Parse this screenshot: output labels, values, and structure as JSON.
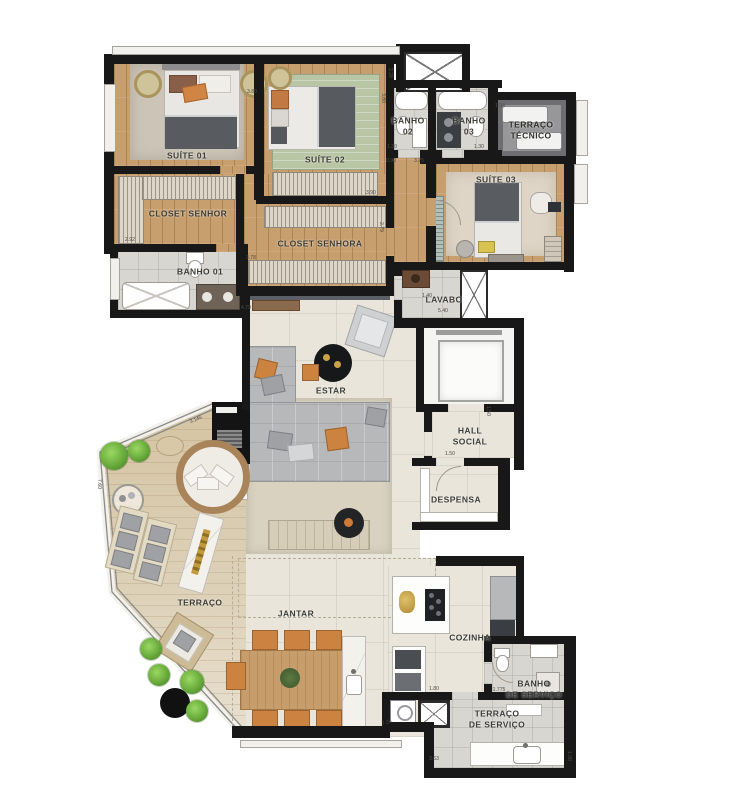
{
  "plan": {
    "title": "apartment floor plan",
    "rooms": {
      "suite01": {
        "label": "SUÍTE 01"
      },
      "suite02": {
        "label": "SUÍTE 02"
      },
      "suite03": {
        "label": "SUÍTE 03"
      },
      "closet_senhor": {
        "label": "CLOSET SENHOR"
      },
      "closet_senhora": {
        "label": "CLOSET SENHORA"
      },
      "banho01": {
        "label": "BANHO 01"
      },
      "banho02": {
        "label": "BANHO\n02"
      },
      "banho03": {
        "label": "BANHO\n03"
      },
      "terraco_tecnico": {
        "label": "TERRAÇO\nTÉCNICO"
      },
      "lavabo": {
        "label": "LAVABO"
      },
      "hall_social": {
        "label": "HALL\nSOCIAL"
      },
      "despensa": {
        "label": "DESPENSA"
      },
      "estar": {
        "label": "ESTAR"
      },
      "terraco": {
        "label": "TERRAÇO"
      },
      "jantar": {
        "label": "JANTAR"
      },
      "cozinha": {
        "label": "COZINHA"
      },
      "banho_servico": {
        "label": "BANHO\nDE SERVIÇO"
      },
      "terraco_servico": {
        "label": "TERRAÇO\nDE SERVIÇO"
      }
    },
    "dimensions": [
      {
        "text": "3.80",
        "x": 252,
        "y": 92,
        "r": 0
      },
      {
        "text": "2.28",
        "x": 390,
        "y": 73,
        "r": 90
      },
      {
        "text": "3.80",
        "x": 383,
        "y": 98,
        "r": 90
      },
      {
        "text": "1.30",
        "x": 392,
        "y": 147,
        "r": 0
      },
      {
        "text": "1.30",
        "x": 479,
        "y": 147,
        "r": 0
      },
      {
        "text": "0.90",
        "x": 391,
        "y": 161,
        "r": 0
      },
      {
        "text": "3.75",
        "x": 419,
        "y": 161,
        "r": 0
      },
      {
        "text": "1.94",
        "x": 500,
        "y": 106,
        "r": 0
      },
      {
        "text": "3.90",
        "x": 371,
        "y": 193,
        "r": 0
      },
      {
        "text": "2.79",
        "x": 381,
        "y": 227,
        "r": 90
      },
      {
        "text": "2.92",
        "x": 130,
        "y": 240,
        "r": 0
      },
      {
        "text": "3.78",
        "x": 251,
        "y": 258,
        "r": 0
      },
      {
        "text": "4.79",
        "x": 246,
        "y": 308,
        "r": 0
      },
      {
        "text": "5.40",
        "x": 443,
        "y": 311,
        "r": 0
      },
      {
        "text": "1.40",
        "x": 427,
        "y": 296,
        "r": 0
      },
      {
        "text": "1.50",
        "x": 488,
        "y": 411,
        "r": 90
      },
      {
        "text": "1.50",
        "x": 450,
        "y": 454,
        "r": 0
      },
      {
        "text": "3.145",
        "x": 196,
        "y": 420,
        "r": -23
      },
      {
        "text": "7.60",
        "x": 99,
        "y": 484,
        "r": 90
      },
      {
        "text": "1.80",
        "x": 434,
        "y": 689,
        "r": 0
      },
      {
        "text": "1.775",
        "x": 499,
        "y": 690,
        "r": 0
      },
      {
        "text": "7.26",
        "x": 387,
        "y": 723,
        "r": -15
      },
      {
        "text": "3.63",
        "x": 434,
        "y": 759,
        "r": 0
      },
      {
        "text": "1.08",
        "x": 569,
        "y": 756,
        "r": 90
      }
    ],
    "colors": {
      "wall": "#181818",
      "wood": "#c79e6d",
      "deck": "#d8caae",
      "tileSocial": "#e9e5db",
      "tileBath": "#d8d6d1",
      "carpet": "#ccc5b7",
      "accent": "#cc8340",
      "rugGreen": "#b9c6a5",
      "slate": "#5a6065",
      "plantGreen": "#6faf45"
    }
  }
}
